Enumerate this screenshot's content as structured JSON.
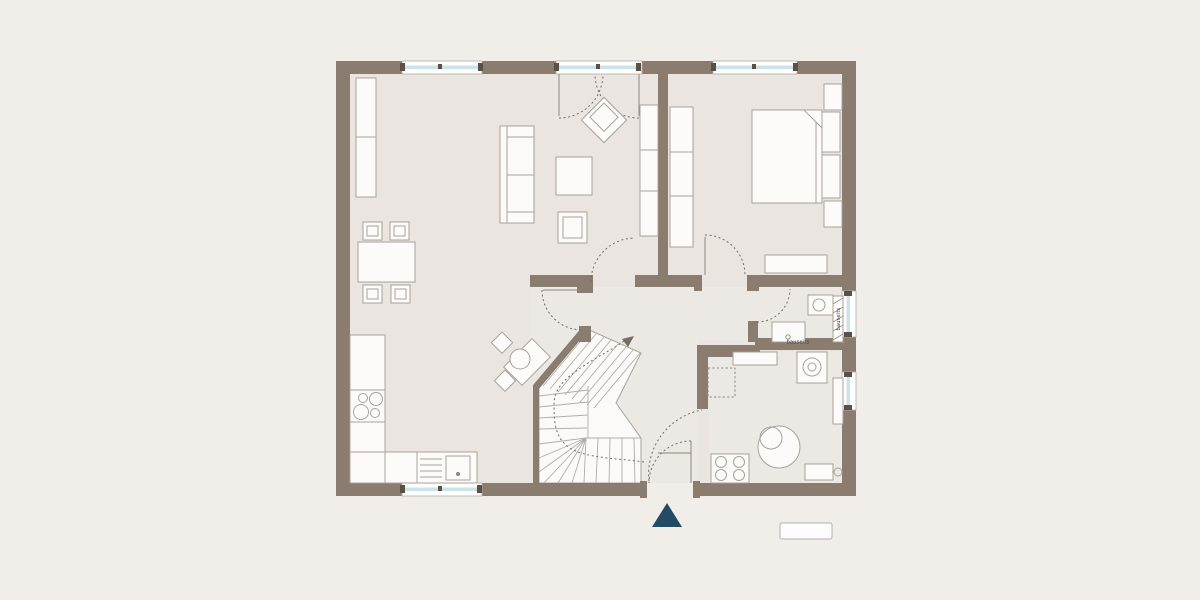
{
  "diagram": {
    "kind": "architectural-floor-plan",
    "labels": {
      "shower_strip": "bauseits",
      "bath_wall_note": "bauseits"
    },
    "markers": {
      "entrance_marker": "entrance-arrow-triangle",
      "legend_box": "empty-label-box"
    },
    "colors": {
      "background": "#f1ede9",
      "room_floor": "#eae5e1",
      "secondary_floor": "#ece8e4",
      "walls": "#8a7c6f",
      "window_glass": "#cde3ec",
      "furniture_outline": "#a8a19a",
      "entrance_arrow": "#234b64"
    }
  }
}
